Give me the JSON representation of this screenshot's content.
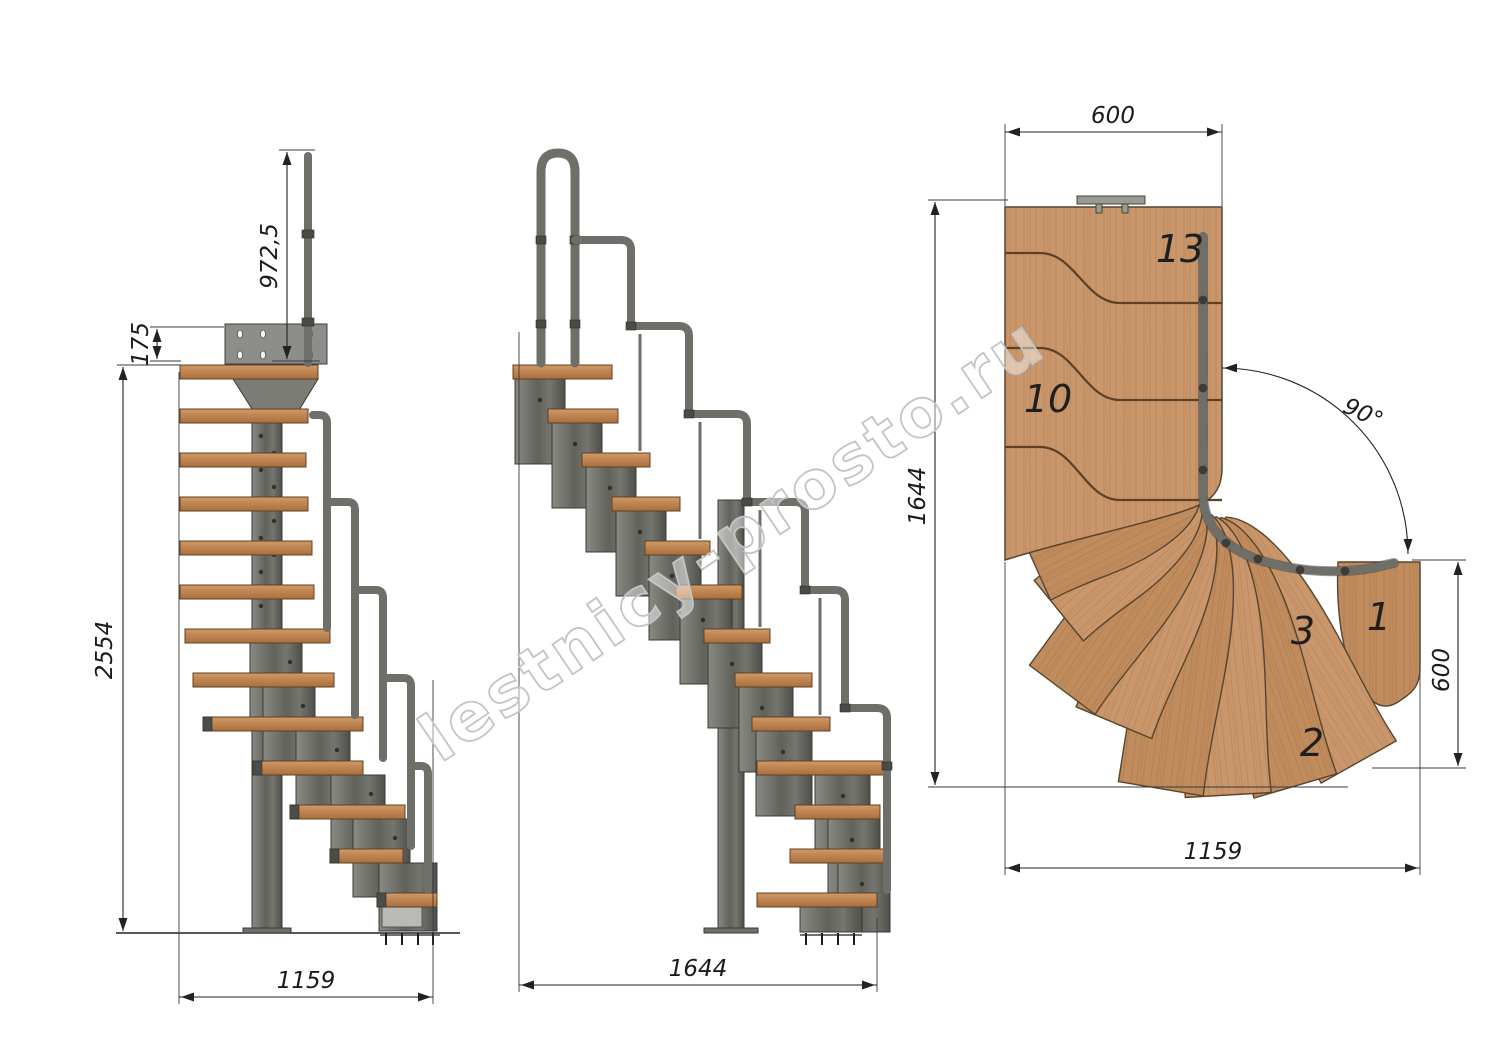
{
  "watermark": {
    "text": "lestnicy-prosto.ru",
    "color": "#c4c4c4"
  },
  "front_view": {
    "overall_height": "2554",
    "handrail_height": "972,5",
    "top_offset": "175",
    "base_width": "1159"
  },
  "side_view": {
    "base_length": "1644"
  },
  "plan_view": {
    "flight_width": "600",
    "overall_length": "1644",
    "turn_angle": "90°",
    "exit_width": "600",
    "overall_width": "1159",
    "steps": {
      "s13": "13",
      "s10": "10",
      "s3": "3",
      "s2": "2",
      "s1": "1"
    }
  },
  "colors": {
    "background": "#ffffff",
    "wood_side": "#bf8756",
    "wood_plan": "#c9976b",
    "metal": "#6f6f69",
    "metal_dark": "#3d3d39",
    "dimension_line": "#222222",
    "watermark": "#c4c4c4"
  }
}
